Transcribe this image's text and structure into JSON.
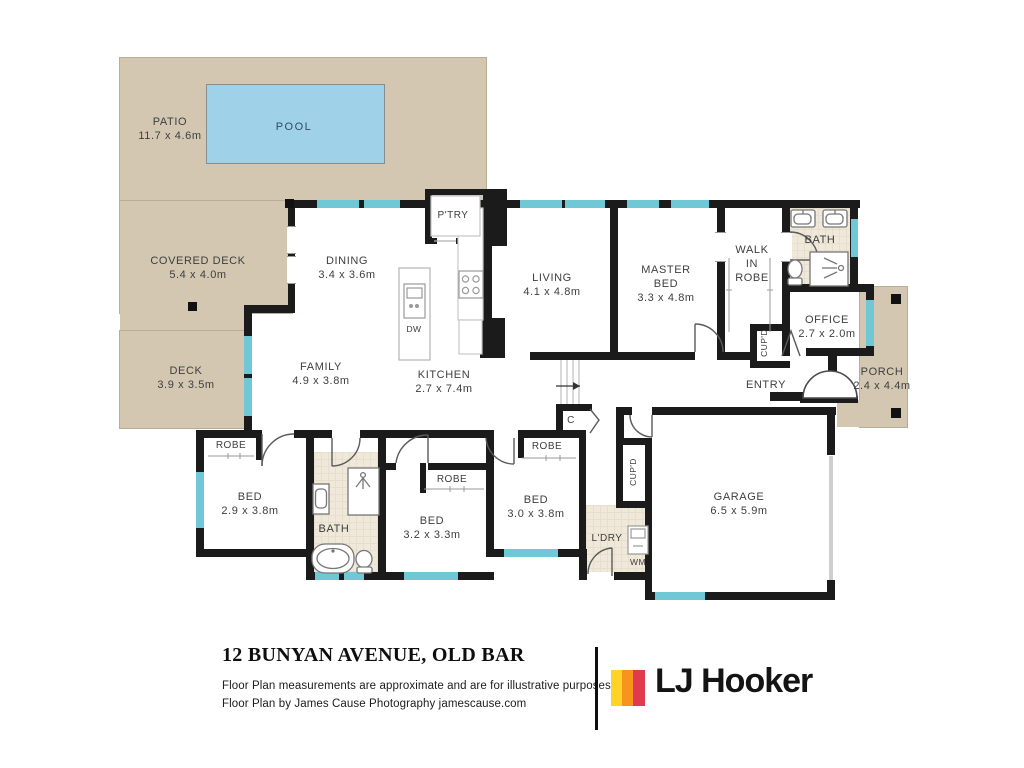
{
  "plan": {
    "labels": {
      "patio": {
        "name": "PATIO",
        "dims": "11.7 x 4.6m"
      },
      "pool": {
        "name": "POOL"
      },
      "covered_deck": {
        "name": "COVERED DECK",
        "dims": "5.4 x 4.0m"
      },
      "deck": {
        "name": "DECK",
        "dims": "3.9 x 3.5m"
      },
      "pantry": {
        "name": "P'TRY"
      },
      "dining": {
        "name": "DINING",
        "dims": "3.4 x 3.6m"
      },
      "family": {
        "name": "FAMILY",
        "dims": "4.9 x 3.8m"
      },
      "kitchen": {
        "name": "KITCHEN",
        "dims": "2.7 x 7.4m"
      },
      "dw": {
        "name": "DW"
      },
      "living": {
        "name": "LIVING",
        "dims": "4.1 x 4.8m"
      },
      "master_bed": {
        "name": "MASTER BED",
        "dims": "3.3 x 4.8m"
      },
      "walk_in_robe": {
        "name": "WALK IN ROBE"
      },
      "bath_ensuite": {
        "name": "BATH"
      },
      "office": {
        "name": "OFFICE",
        "dims": "2.7 x 2.0m"
      },
      "porch": {
        "name": "PORCH",
        "dims": "2.4 x 4.4m"
      },
      "entry": {
        "name": "ENTRY"
      },
      "cupd_hall": {
        "name": "CUP'D"
      },
      "cupd_garage": {
        "name": "CUP'D"
      },
      "c_cupboard": {
        "name": "C"
      },
      "garage": {
        "name": "GARAGE",
        "dims": "6.5 x 5.9m"
      },
      "laundry": {
        "name": "L'DRY"
      },
      "wm": {
        "name": "WM"
      },
      "robe1": {
        "name": "ROBE"
      },
      "robe2": {
        "name": "ROBE"
      },
      "robe3": {
        "name": "ROBE"
      },
      "bed1": {
        "name": "BED",
        "dims": "2.9 x 3.8m"
      },
      "bed2": {
        "name": "BED",
        "dims": "3.2 x 3.3m"
      },
      "bed3": {
        "name": "BED",
        "dims": "3.0 x 3.8m"
      }
    }
  },
  "footer": {
    "address": "12 BUNYAN AVENUE, OLD BAR",
    "disclaimer_line1": "Floor Plan measurements are approximate and are for illustrative purposes only.",
    "disclaimer_line2": "Floor Plan by James Cause Photography jamescause.com",
    "brand_name": "LJ Hooker"
  },
  "colors": {
    "wall": "#1b1b1b",
    "outdoor_beige": "#d3c7b1",
    "pool_blue": "#9fd2e9",
    "window_teal": "#70c7d5",
    "bath_floor": "#f0e9da",
    "brand_yellow": "#ffd227",
    "brand_orange": "#f7941e",
    "brand_red": "#e03a4e"
  }
}
